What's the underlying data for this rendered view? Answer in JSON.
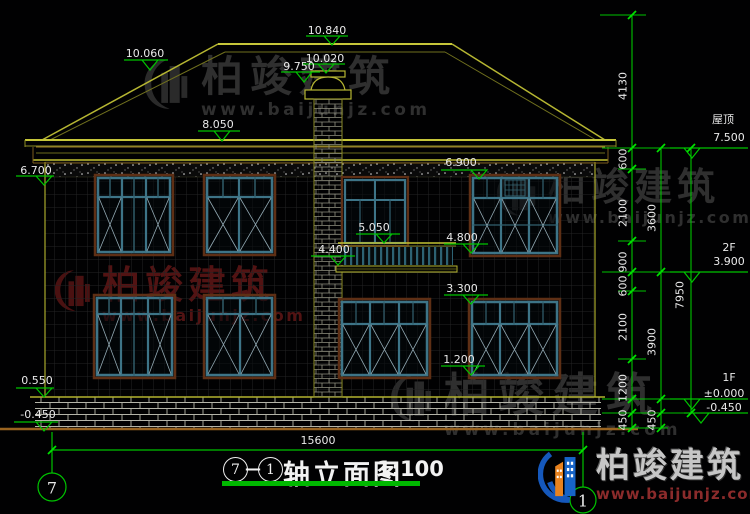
{
  "levels": {
    "ridge": "10.840",
    "roof_edge": "10.060",
    "chimney_top": "10.020",
    "chimney_cap": "9.750",
    "eave": "8.050",
    "wall_band": "6.700",
    "win2f_head": "6.900",
    "balcony_rail": "5.050",
    "balcony_slab": "4.400",
    "win2f_sill": "4.800",
    "win1f_head": "3.300",
    "win1f_sill": "1.200",
    "plinth_top": "0.550",
    "ground": "-0.450"
  },
  "right_panel": {
    "roof_label": "屋顶",
    "roof_value": "7.500",
    "floor2_label": "2F",
    "floor2_value": "3.900",
    "floor1_label": "1F",
    "floor1_value": "±0.000",
    "basement_value": "-0.450"
  },
  "dims": {
    "top": "4130",
    "total": "7950",
    "width": "15600",
    "chain_a": [
      "600",
      "2100",
      "900",
      "600",
      "2100",
      "1200",
      "450"
    ],
    "chain_b": [
      "3600",
      "3900",
      "450"
    ]
  },
  "title": {
    "axis_left": "7",
    "separator": "—",
    "axis_right": "1",
    "name": "轴立面图",
    "scale": "1:100"
  },
  "axes": {
    "left_bubble": "7",
    "right_bubble": "1"
  },
  "watermark": {
    "brand": "柏竣建筑",
    "url": "www.baijunjz.com"
  },
  "logo": {
    "brand": "柏竣建筑",
    "url": "www.baijunjz.com"
  },
  "palette": {
    "background": "#010102",
    "dimension_green": "#00c400",
    "drawing_yellow": "#b6b632",
    "window_teal": "#3d7487",
    "ground_orange": "#9a6420",
    "watermark_gray": "#2f2f2f",
    "watermark_red": "#521313"
  }
}
